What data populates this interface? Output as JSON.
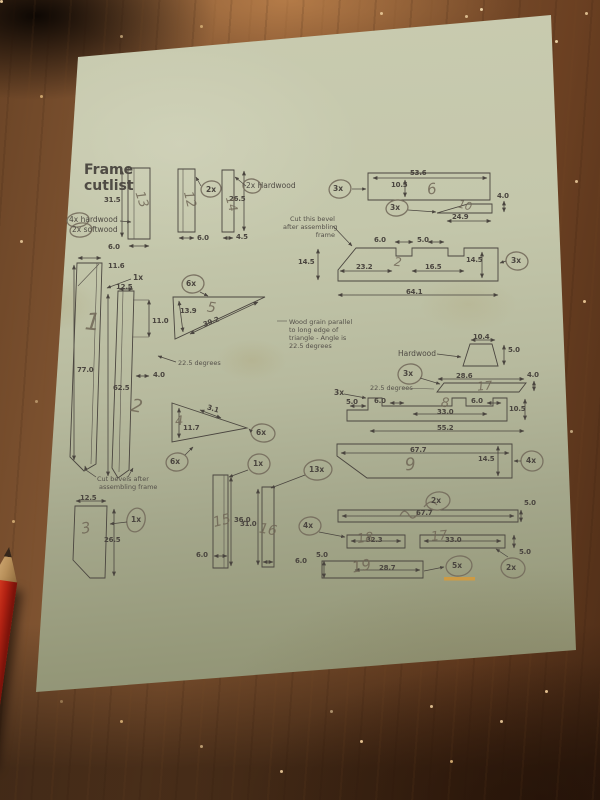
{
  "colors": {
    "paper": "#c2c5a8",
    "wood_mid": "#7a5130",
    "wood_dark": "#2c1a0d",
    "pencil_red": "#c22815",
    "ink": "#4a453f",
    "graphite": "#8a8172",
    "highlight": "#d79b3a"
  },
  "title": "Frame cutlist",
  "materials": {
    "line1_qty": "4x",
    "line1_mat": "hardwood",
    "line2_qty": "2x",
    "line2_mat": "softwood"
  },
  "top_bars": {
    "bar1": {
      "height": "31.5",
      "width": "6.0",
      "scribble": "13"
    },
    "bar2": {
      "qty": "2x",
      "width": "6.0",
      "scribble": "12"
    },
    "bar3": {
      "label": "2x Hardwood",
      "height": "26.5",
      "width": "4.5",
      "scribble": "14"
    }
  },
  "part6": {
    "qty": "3x",
    "length": "53.6",
    "height": "10.5",
    "num": "6",
    "strip": {
      "qty": "3x",
      "length": "24.9",
      "height": "4.0",
      "scribble": "10"
    },
    "note": [
      "Cut this bevel",
      "after assembling",
      "frame"
    ]
  },
  "part2r": {
    "qty": "3x",
    "top1": "6.0",
    "top2": "5.0",
    "seg1": "23.2",
    "seg2": "16.5",
    "left": "14.5",
    "right": "14.5",
    "total": "64.1",
    "num": "2"
  },
  "part1": {
    "qty": "1x",
    "top": "11.6",
    "height": "77.0",
    "num": "1"
  },
  "part2l": {
    "top": "12.5",
    "notch_h": "11.0",
    "notch_w": "4.0",
    "height": "62.5",
    "angle": "22.5 degrees",
    "num": "2"
  },
  "part5": {
    "qty": "6x",
    "side": "13.9",
    "hyp": "39.2",
    "num": "5",
    "note": [
      "Wood grain parallel",
      "to long edge of",
      "triangle - Angle is",
      "22.5 degrees"
    ]
  },
  "part4": {
    "qty_a": "6x",
    "qty_b": "6x",
    "top": "3.1",
    "side": "11.7",
    "num": "4",
    "note": [
      "Cut bevels after",
      "assembling frame"
    ]
  },
  "part3": {
    "qty": "1x",
    "width": "12.5",
    "height": "26.5",
    "num": "3"
  },
  "bar15": {
    "qty": "1x",
    "height": "36.0",
    "width": "6.0",
    "num": "15"
  },
  "bar16": {
    "qty": "13x",
    "height": "31.0",
    "width": "6.0",
    "num": "16"
  },
  "hardwood_piece": {
    "label": "Hardwood",
    "length": "10.4",
    "height": "5.0"
  },
  "part7": {
    "qty": "3x",
    "length": "28.6",
    "height": "4.0",
    "angle": "22.5 degrees",
    "num": "17"
  },
  "part8": {
    "qty": "3x",
    "d_left": "5.0",
    "tab1": "6.0",
    "tab2": "6.0",
    "mid": "33.0",
    "height": "10.5",
    "total": "55.2",
    "num": "8"
  },
  "part9": {
    "qty": "4x",
    "length": "67.7",
    "height": "14.5",
    "num": "9"
  },
  "row1": {
    "qty": "2x",
    "length": "67.7",
    "height": "5.0"
  },
  "row2": {
    "qty": "4x",
    "len1": "32.3",
    "num1": "18",
    "len2": "33.0",
    "num2": "17",
    "height": "5.0"
  },
  "row3": {
    "height": "5.0",
    "length": "28.7",
    "num": "19",
    "qty_a": "5x",
    "qty_b": "2x"
  }
}
